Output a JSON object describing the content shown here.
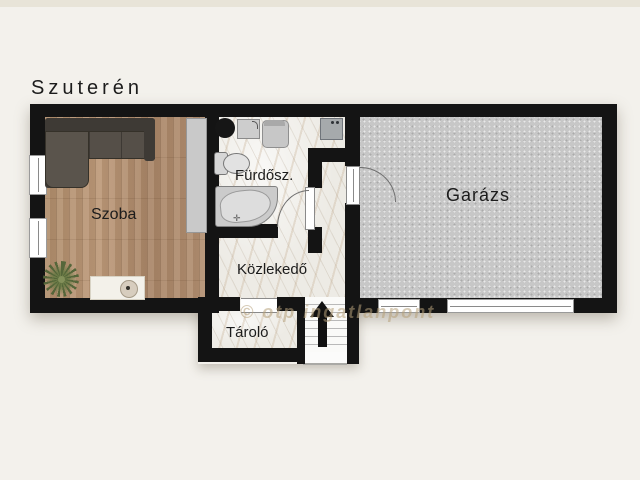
{
  "title": "Szuterén",
  "floorplan": {
    "rooms": [
      {
        "id": "szoba",
        "label": "Szoba",
        "floor": "wood"
      },
      {
        "id": "furdoszoba",
        "label": "Fürdősz.",
        "floor": "marble"
      },
      {
        "id": "kozlekedo",
        "label": "Közlekedő",
        "floor": "marble"
      },
      {
        "id": "tarolo",
        "label": "Tároló",
        "floor": "marble"
      },
      {
        "id": "garazs",
        "label": "Garázs",
        "floor": "concrete"
      }
    ],
    "watermark": "© otp ingatlanpont",
    "stairs_direction": "up",
    "furniture": [
      "corner-sofa",
      "wardrobe",
      "potted-plant",
      "rug",
      "pouf",
      "round-basin",
      "vanity-sink",
      "chair",
      "washing-machine",
      "toilet",
      "corner-bathtub",
      "staircase-up-arrow"
    ],
    "colors": {
      "wall": "#141414",
      "wood_floor": "#b2906f",
      "marble_floor": "#edebe5",
      "concrete_floor": "#c7c7c7",
      "background": "#f3f1ec",
      "watermark": "#b6a07a"
    }
  }
}
